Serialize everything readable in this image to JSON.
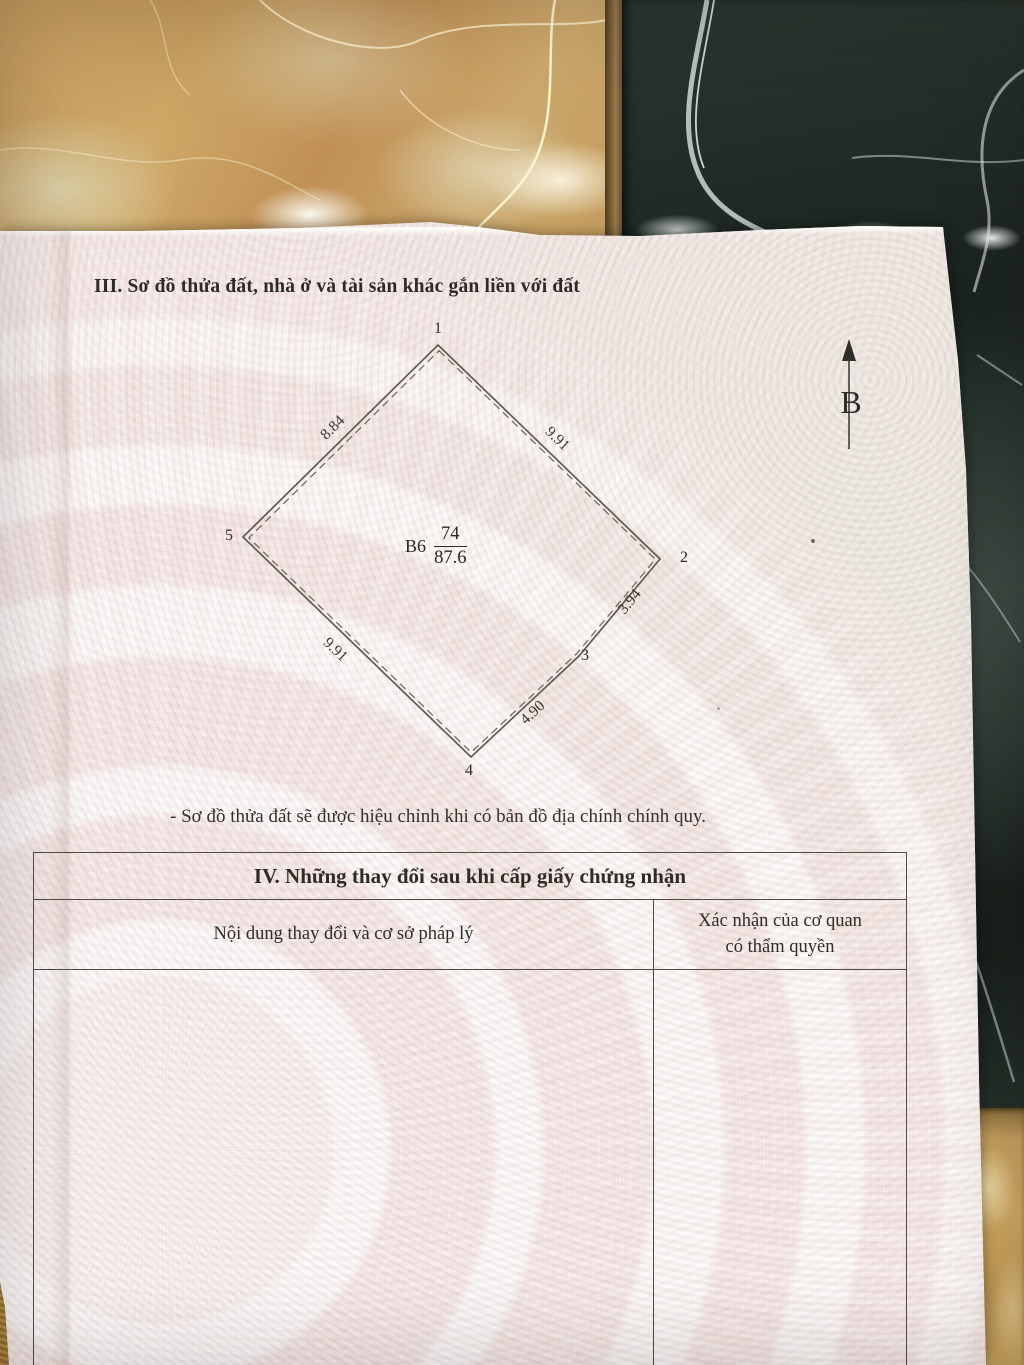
{
  "document": {
    "section_iii": {
      "heading": "III. Sơ đồ thửa đất, nhà ở và tài sản khác gắn liền với đất",
      "footnote": "- Sơ đồ thửa đất sẽ được hiệu chỉnh khi có bản đồ địa chính chính quy."
    },
    "plot_diagram": {
      "block_label": "B6",
      "parcel_number": "74",
      "parcel_area": "87.6",
      "north_arrow_label": "B",
      "vertex_labels": [
        "1",
        "2",
        "3",
        "4",
        "5"
      ],
      "edge_lengths": [
        {
          "edge": "5-1",
          "length": "8.84"
        },
        {
          "edge": "1-2",
          "length": "9.91"
        },
        {
          "edge": "2-3",
          "length": "3.94"
        },
        {
          "edge": "3-4",
          "length": "4.90"
        },
        {
          "edge": "4-5",
          "length": "9.91"
        }
      ]
    },
    "section_iv": {
      "heading": "IV. Những thay đổi sau khi cấp giấy chứng nhận",
      "columns": [
        {
          "header": "Nội dung thay đổi và cơ sở pháp lý"
        },
        {
          "header_line1": "Xác nhận của cơ quan",
          "header_line2": "có thẩm quyền"
        }
      ]
    }
  },
  "colors": {
    "paper": "#f3e7e3",
    "ink": "#34312b",
    "diagram_line": "#5f5b52",
    "tile_beige_marble": "#c79f62",
    "tile_dark_marble": "#222d27",
    "tile_tan": "#c29a55",
    "grout": "#7b6038"
  }
}
